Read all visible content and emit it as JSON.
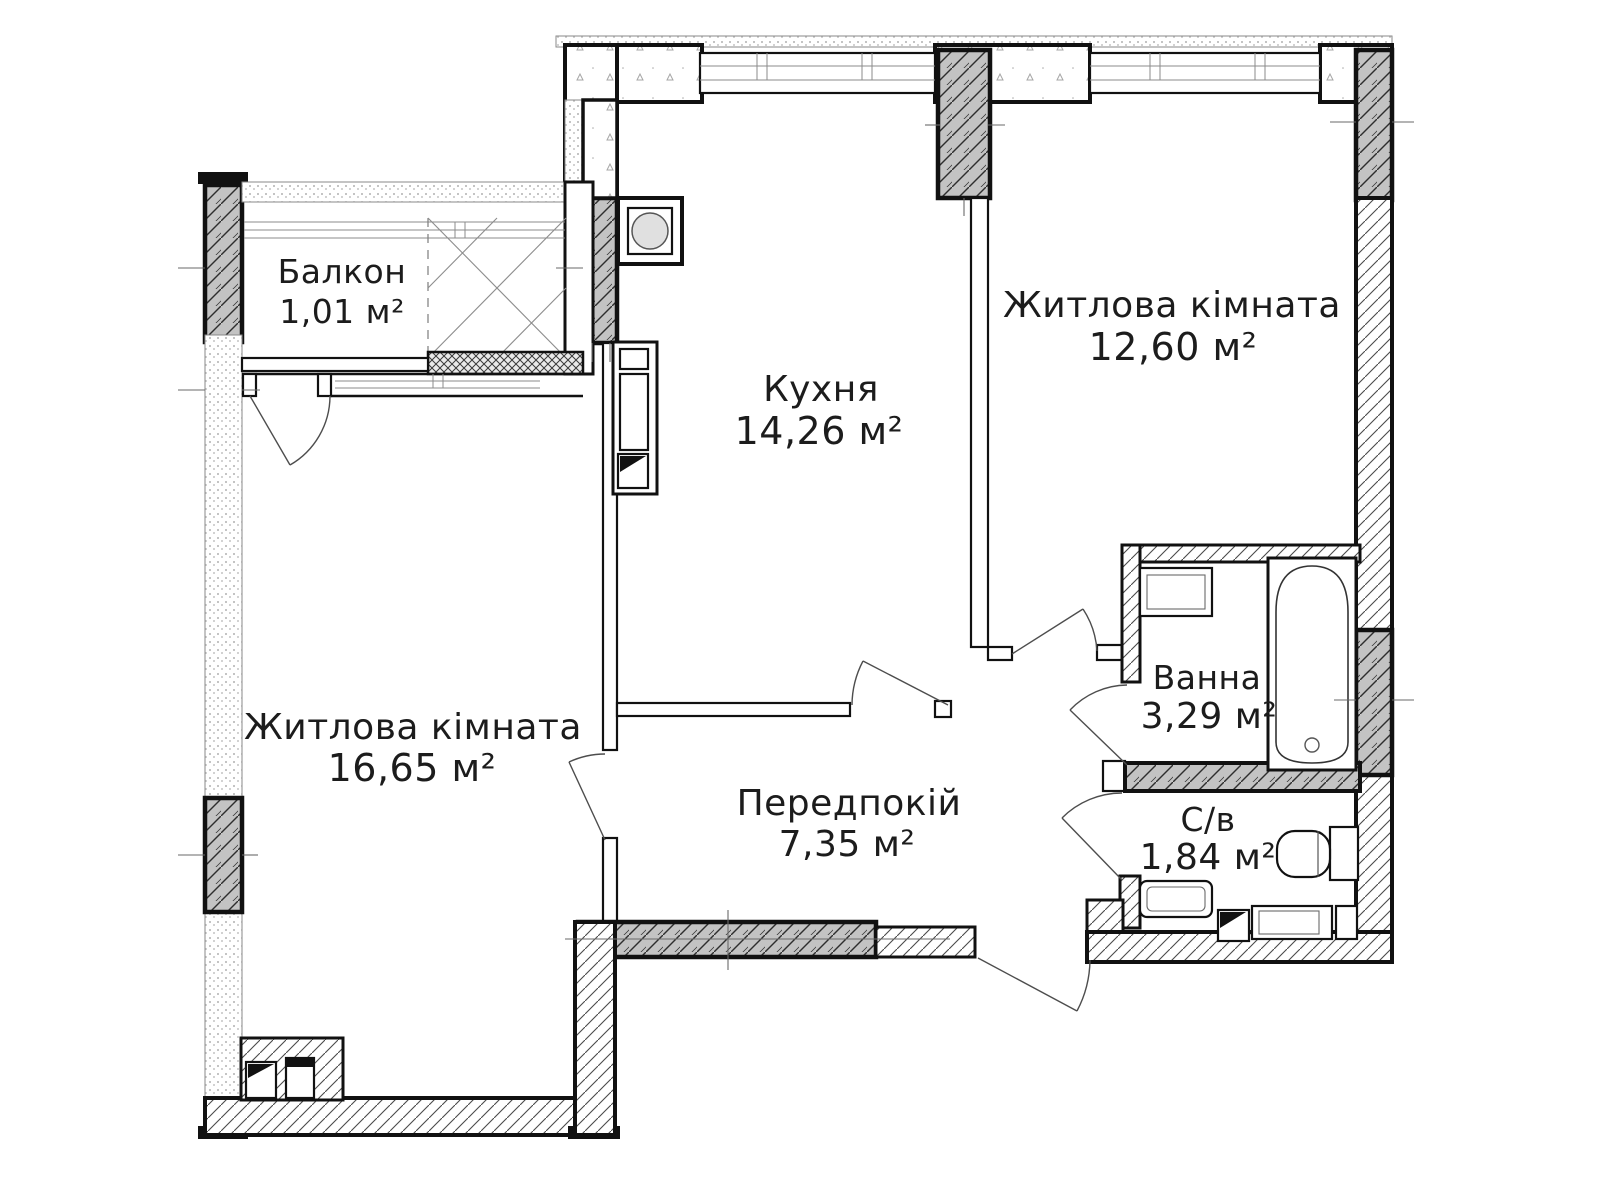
{
  "plan": {
    "rooms": [
      {
        "name": "Балкон",
        "area": "1,01 м²"
      },
      {
        "name": "Житлова кімната",
        "area": "12,60 м²"
      },
      {
        "name": "Кухня",
        "area": "14,26 м²"
      },
      {
        "name": "Житлова кімната",
        "area": "16,65 м²"
      },
      {
        "name": "Ванна",
        "area": "3,29 м²"
      },
      {
        "name": "Передпокій",
        "area": "7,35 м²"
      },
      {
        "name": "С/в",
        "area": "1,84 м²"
      }
    ]
  },
  "colors": {
    "wall": "#111111",
    "pillar_fill": "#c3c3c3",
    "hatch_line": "#3c3c3c",
    "stipple_dot": "#9a9a9a",
    "thin_line": "#6a6a6a",
    "text": "#1c1c1c",
    "background": "#ffffff"
  }
}
